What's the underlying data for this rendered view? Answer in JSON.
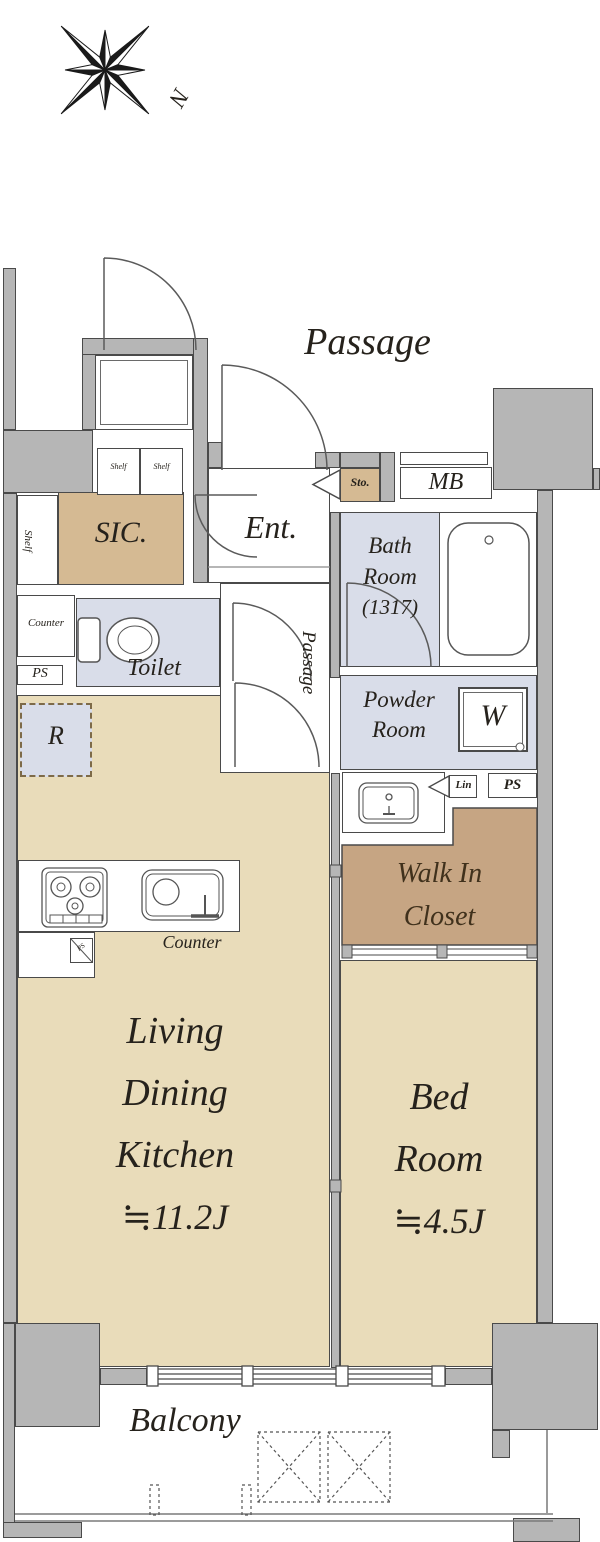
{
  "colors": {
    "wall": "#b6b6b6",
    "line": "#4a4a4a",
    "tan": "#e9dcba",
    "tan2": "#d5ba93",
    "brown": "#c6a583",
    "lav": "#d9dde9"
  },
  "compass": {
    "north": "N"
  },
  "outside": {
    "passage": "Passage",
    "balcony": "Balcony"
  },
  "entry": {
    "ent": "Ent.",
    "sto": "Sto.",
    "mb": "MB",
    "sic": "SIC.",
    "shelf_1": "Shelf",
    "shelf_2": "Shelf",
    "shelf_side": "Shelf"
  },
  "wet": {
    "bath_1": "Bath",
    "bath_2": "Room",
    "bath_3": "(1317)",
    "toilet": "Toilet",
    "toilet_counter": "Counter",
    "toilet_ps": "PS",
    "passage": "Passage",
    "powder_1": "Powder",
    "powder_2": "Room",
    "washer": "W",
    "lin": "Lin",
    "ps": "PS"
  },
  "wic": {
    "l1": "Walk In",
    "l2": "Closet"
  },
  "living": {
    "r": "R",
    "counter": "Counter",
    "ps": "PS",
    "l1": "Living",
    "l2": "Dining",
    "l3": "Kitchen",
    "size": "≒11.2J"
  },
  "bedroom": {
    "l1": "Bed",
    "l2": "Room",
    "size": "≒4.5J"
  }
}
